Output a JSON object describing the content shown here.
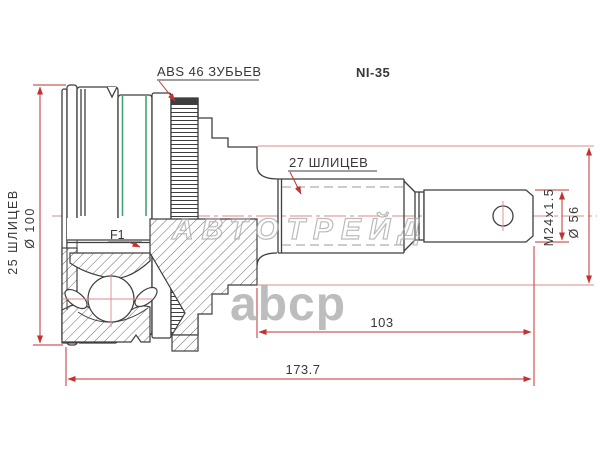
{
  "drawing": {
    "kind": "CV joint (outer) dimensional drawing",
    "part_number": "NI-35",
    "callouts": {
      "abs_ring": "ABS 46 ЗУБЬЕВ",
      "shaft_splines": "27 ШЛИЦЕВ",
      "hub_splines": "25 ШЛИЦЕВ",
      "body_diameter": "Ø 100",
      "grease_code": "F1",
      "thread": "M24x1.5",
      "end_diameter": "Ø 56",
      "thread_section_length": "103",
      "total_length": "173.7"
    },
    "watermark": {
      "brand": "АВТОТРЕЙД",
      "logo": "abcp"
    },
    "colors": {
      "line": "#3f3f3f",
      "dimension_red": "#c23232",
      "centerline_pink": "#dc8a8a",
      "clamp_green": "#46a275",
      "watermark_gray": "#ababab",
      "background": "#ffffff"
    }
  }
}
